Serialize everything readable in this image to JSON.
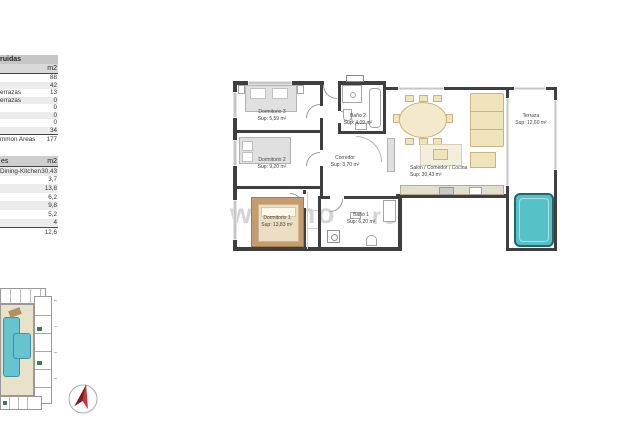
{
  "tables": {
    "construidas": {
      "header_fragment": "ruidas",
      "unit_header": "m2",
      "rows": [
        {
          "label": "",
          "value": "88"
        },
        {
          "label": "",
          "value": "42"
        },
        {
          "label": "errazas",
          "value": "13"
        },
        {
          "label": "errazas",
          "value": "0"
        },
        {
          "label": "",
          "value": "0"
        },
        {
          "label": "",
          "value": "0"
        },
        {
          "label": "",
          "value": "0"
        },
        {
          "label": "",
          "value": "34"
        }
      ],
      "total": {
        "label": "mmon Areas",
        "value": "177"
      }
    },
    "utiles": {
      "header_fragment": "es",
      "unit_header": "m2",
      "rows": [
        {
          "label": "Dining-Kitchen",
          "value": "30,43"
        },
        {
          "label": "",
          "value": "3,7"
        },
        {
          "label": "",
          "value": "13,8"
        },
        {
          "label": "",
          "value": "6,2"
        },
        {
          "label": "",
          "value": "9,8"
        },
        {
          "label": "",
          "value": "5,2"
        },
        {
          "label": "",
          "value": "4"
        }
      ],
      "extra_row": {
        "label": "",
        "value": "12,6"
      }
    }
  },
  "floorplan": {
    "rooms": [
      {
        "name": "Dormitorio 3",
        "area": "Sup: 5,59 m²"
      },
      {
        "name": "Baño 2",
        "area": "Sup: 4,09 m²"
      },
      {
        "name": "Dormitorio 2",
        "area": "Sup: 9,20 m²"
      },
      {
        "name": "Corredor",
        "area": "Sup: 3,70 m²"
      },
      {
        "name": "Salón / Comedor / Cocina",
        "area": "Sup: 30,43 m²"
      },
      {
        "name": "Dormitorio 1",
        "area": "Sup: 13,83 m²"
      },
      {
        "name": "Baño 1",
        "area": "Sup: 6,20 m²"
      },
      {
        "name": "Terraza",
        "area": "Sup: 12,60 m²"
      }
    ]
  },
  "watermark": {
    "left": "wimmo",
    "right": "ro"
  },
  "colors": {
    "wall": "#3f3f3f",
    "pool": "#56c2c7",
    "pool_border": "#20666b",
    "furniture_beige": "#f0e4ba",
    "site_pool": "#66c3d0",
    "compass_red": "#cf3236"
  }
}
